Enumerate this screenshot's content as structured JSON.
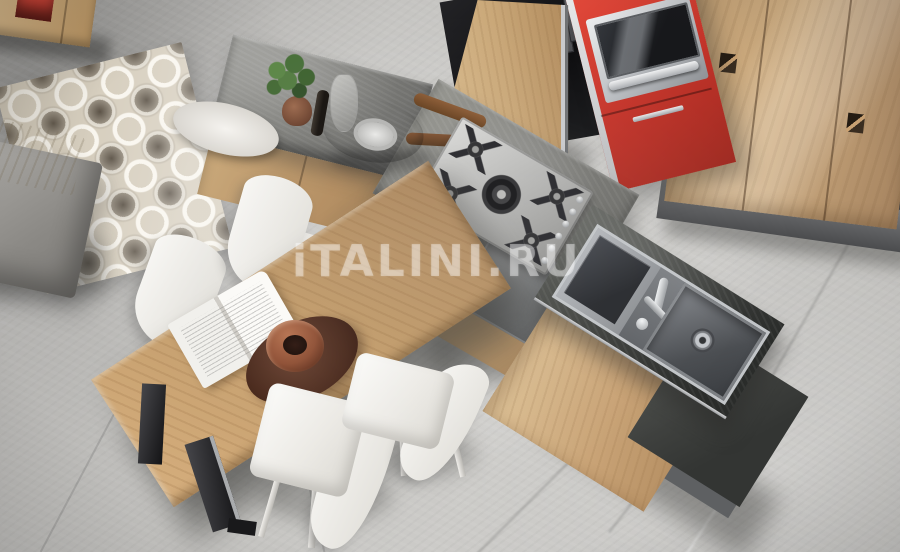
{
  "watermark": {
    "text": "iTALINI.RU"
  },
  "palette": {
    "floor_gray": "#c4c3c0",
    "wood_light": "#cdab7e",
    "wood_table": "#c09a69",
    "stone_counter": "#7d7d79",
    "stone_dark": "#3b3d3a",
    "accent_red": "#c4342a",
    "chair_white": "#f2f1ee",
    "rug_base": "#d7cfbf",
    "steel": "#c2c5c8",
    "plant_green": "#49703a"
  },
  "scene": {
    "objects": [
      "floor",
      "rug",
      "sofa",
      "sideboard",
      "wardrobe",
      "cooker-hood",
      "oven",
      "red-cabinet",
      "tall-cabinet-panel",
      "kitchen-island",
      "cooktop",
      "sink",
      "faucet",
      "dining-table",
      "book",
      "decorative-bowl",
      "chairs",
      "plant",
      "saucepan",
      "tray"
    ]
  }
}
